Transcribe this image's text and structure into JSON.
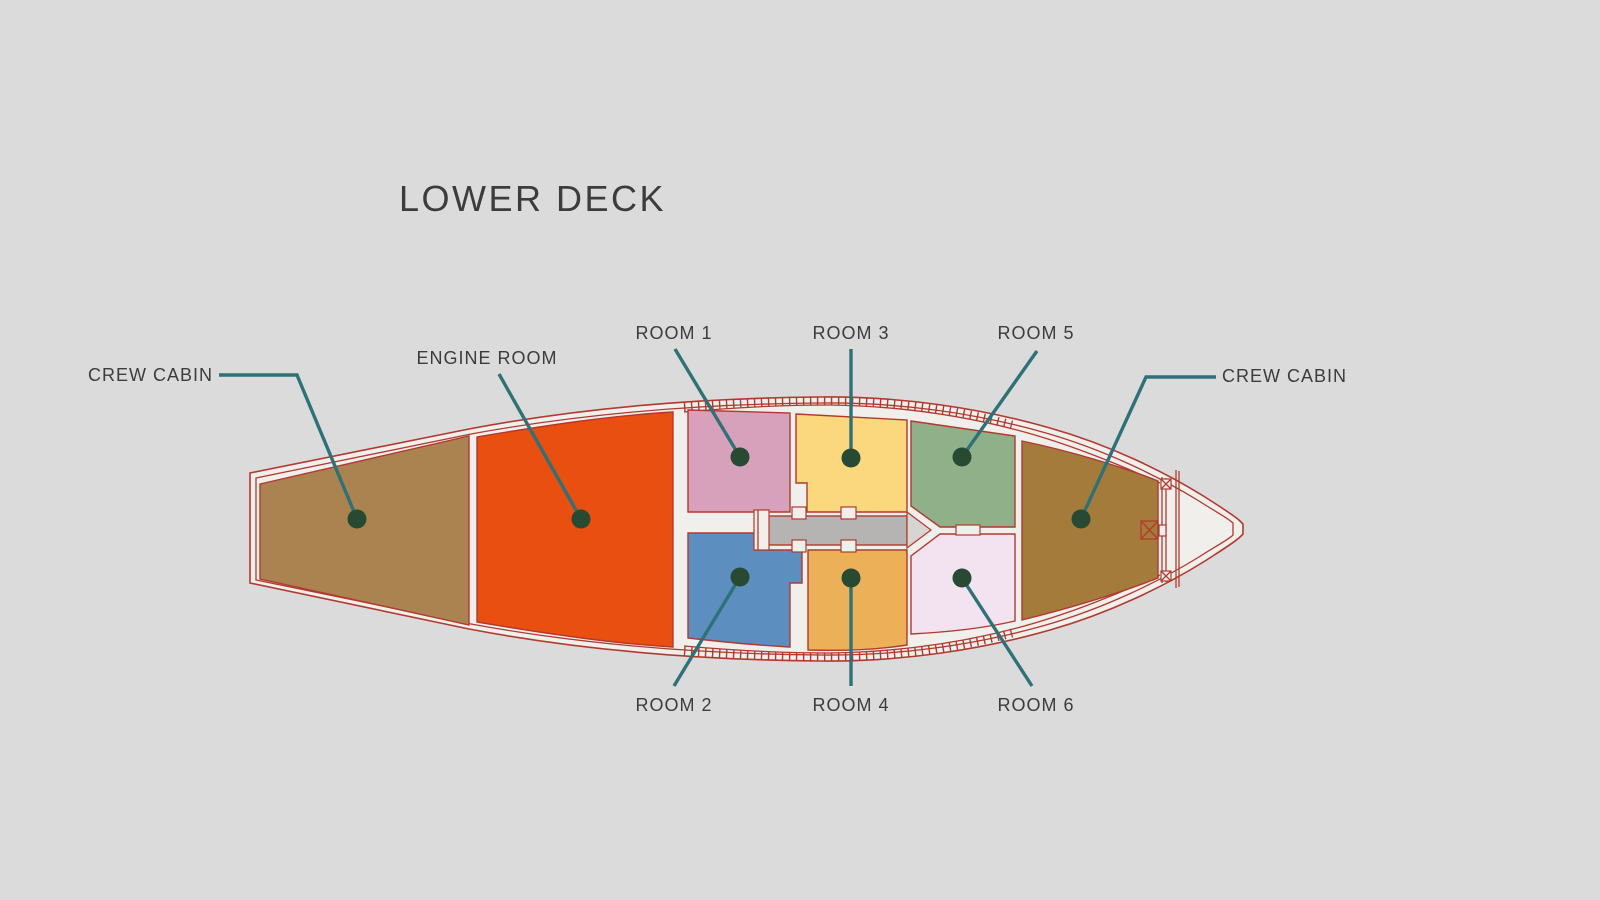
{
  "title": "LOWER DECK",
  "colors": {
    "background": "#dbdbdb",
    "hull_fill": "#f0efec",
    "outline": "#b2392f",
    "leader": "#2e7278",
    "marker": "#284a33",
    "corridor": "#b5b4b2",
    "arrow": "#d6d5d2",
    "text": "#3c3c3c"
  },
  "rooms": [
    {
      "id": "crew-cabin-left",
      "label": "CREW CABIN",
      "color": "#ab8350"
    },
    {
      "id": "engine-room",
      "label": "ENGINE ROOM",
      "color": "#e84f10"
    },
    {
      "id": "room-1",
      "label": "ROOM 1",
      "color": "#d7a0bb"
    },
    {
      "id": "room-2",
      "label": "ROOM 2",
      "color": "#5c8ebf"
    },
    {
      "id": "room-3",
      "label": "ROOM 3",
      "color": "#fbd87d"
    },
    {
      "id": "room-4",
      "label": "ROOM 4",
      "color": "#ecb059"
    },
    {
      "id": "room-5",
      "label": "ROOM 5",
      "color": "#90b08a"
    },
    {
      "id": "room-6",
      "label": "ROOM 6",
      "color": "#f3e3f0"
    },
    {
      "id": "crew-cabin-right",
      "label": "CREW CABIN",
      "color": "#a57b3c"
    }
  ]
}
